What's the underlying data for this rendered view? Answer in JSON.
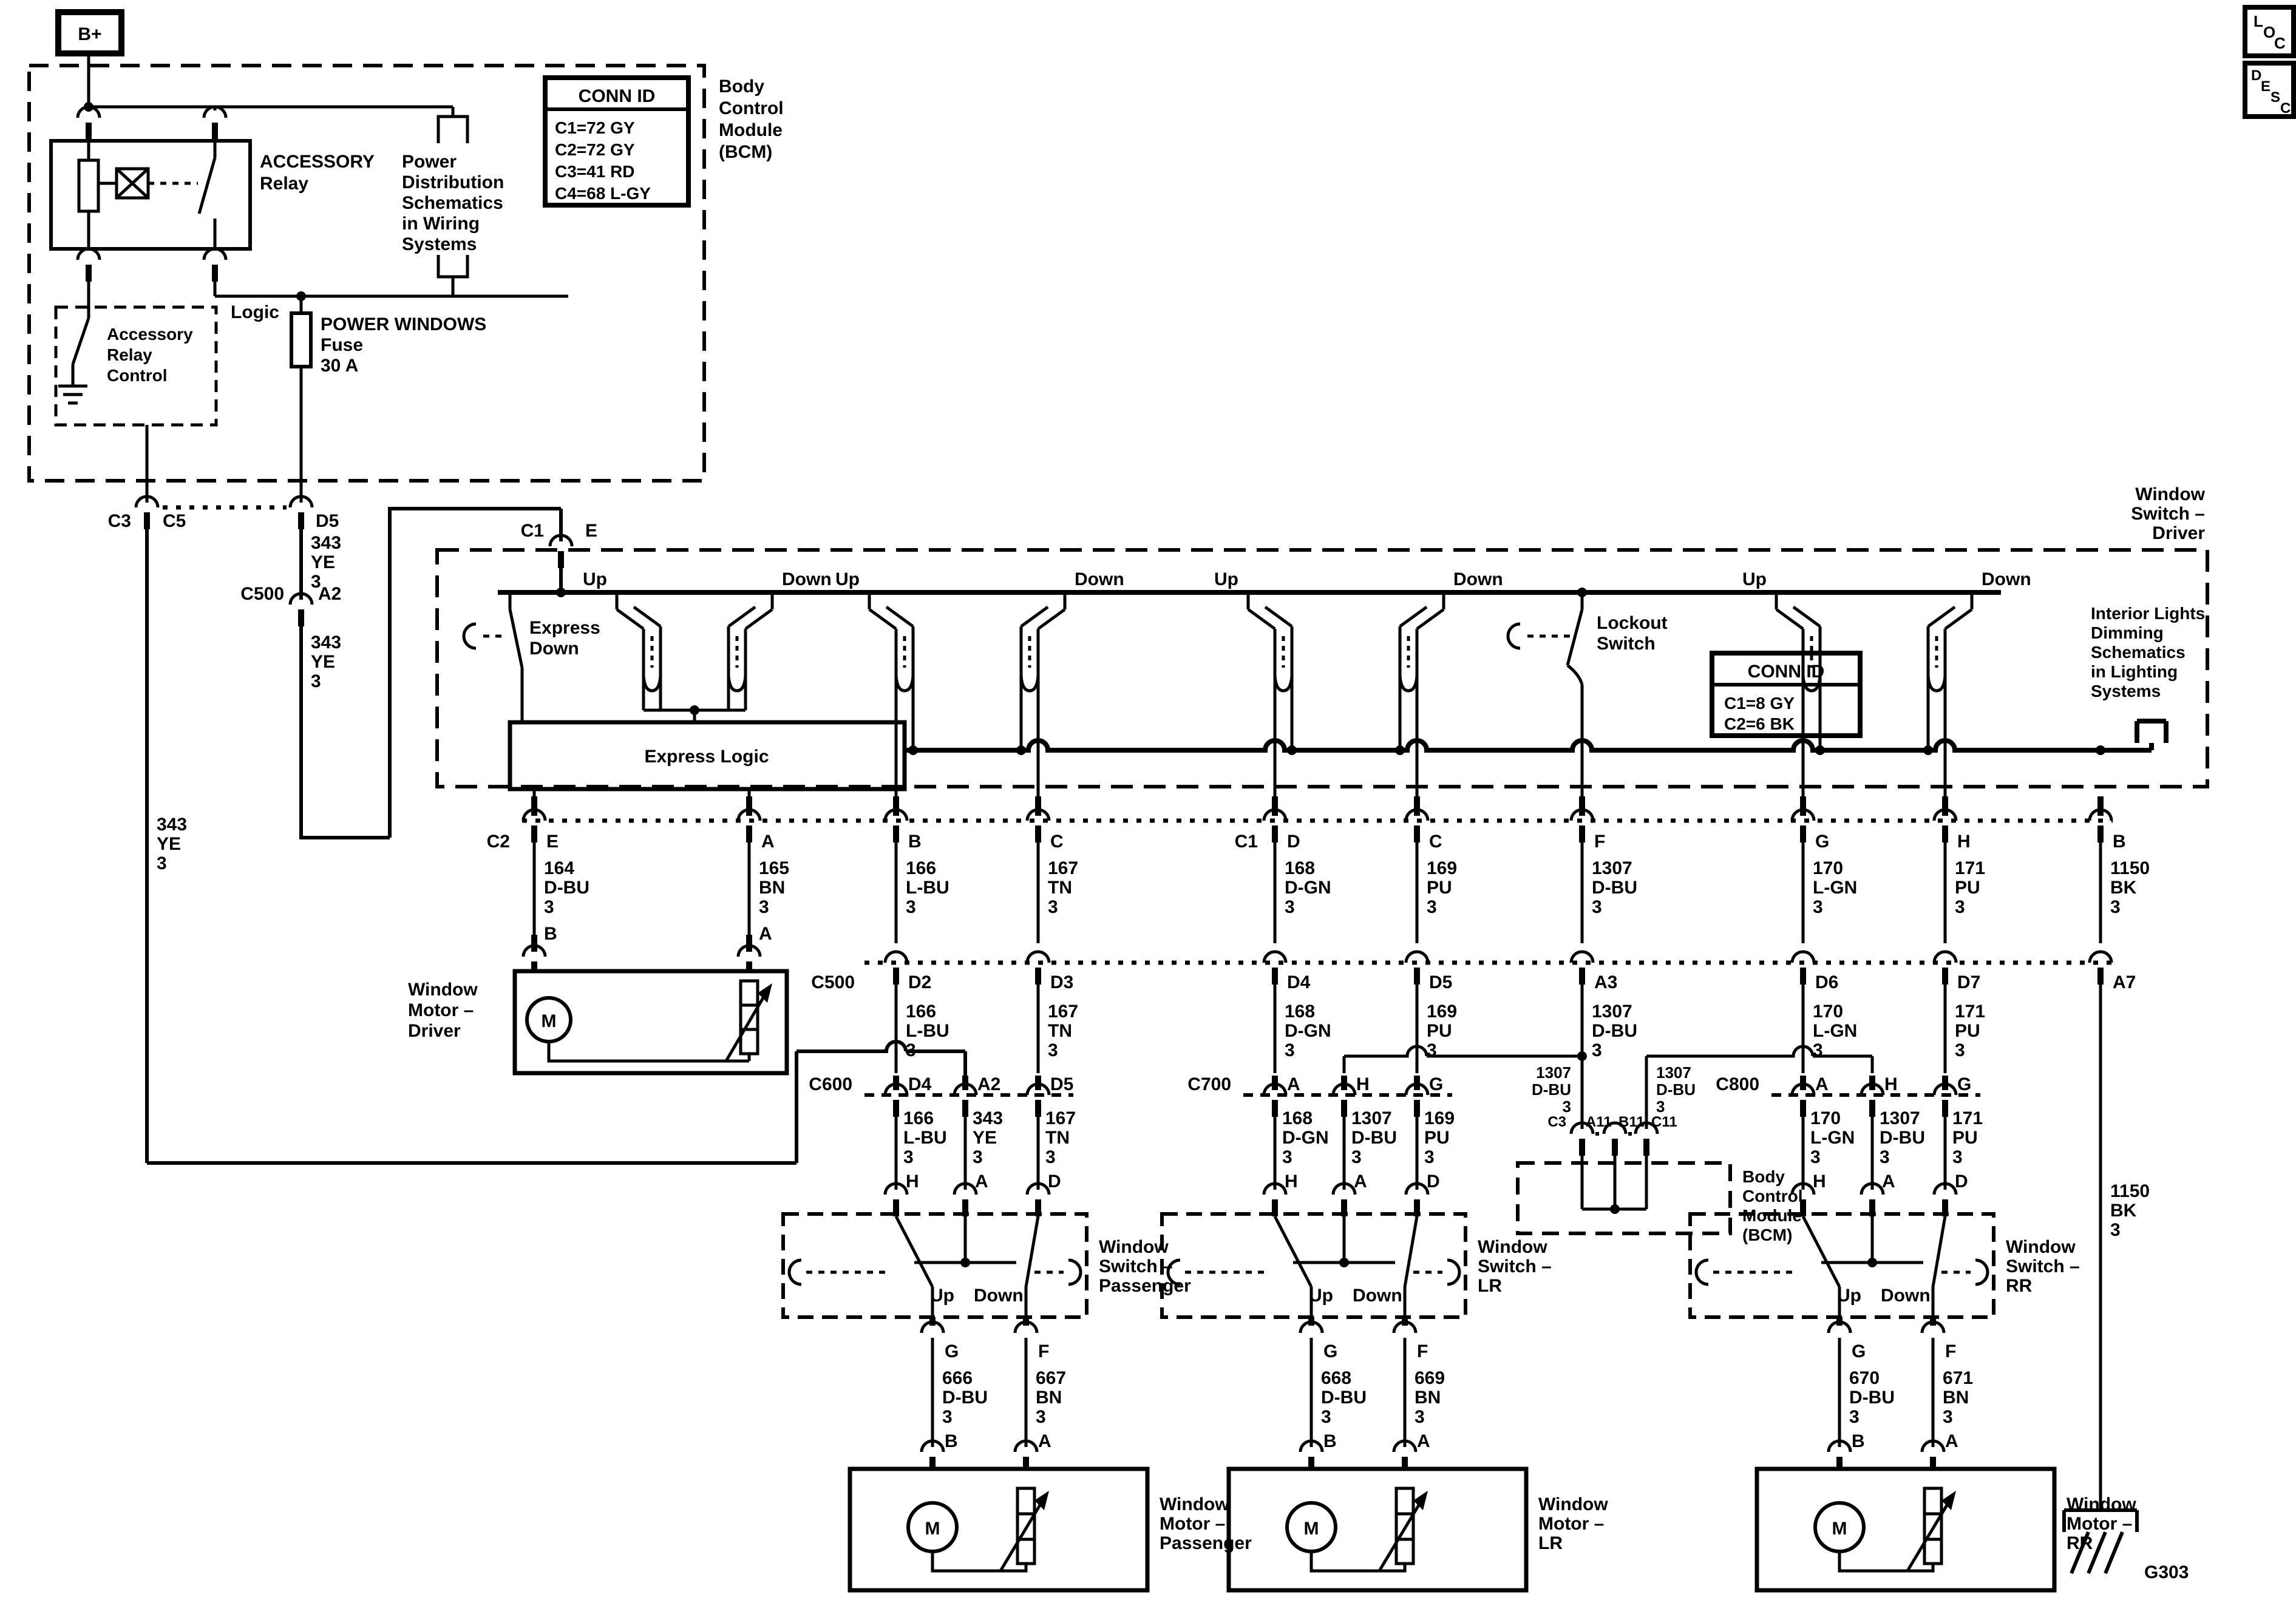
{
  "corner": {
    "loc": [
      "L",
      "O",
      "C"
    ],
    "desc": [
      "D",
      "E",
      "S",
      "C"
    ]
  },
  "top": {
    "b_plus": "B+",
    "accessory_relay": [
      "ACCESSORY",
      "Relay"
    ],
    "power_dist": [
      "Power",
      "Distribution",
      "Schematics",
      "in Wiring",
      "Systems"
    ],
    "conn_id": {
      "header": "CONN ID",
      "rows": [
        "C1=72 GY",
        "C2=72 GY",
        "C3=41 RD",
        "C4=68 L-GY"
      ]
    },
    "bcm": [
      "Body",
      "Control",
      "Module",
      "(BCM)"
    ],
    "arc_control": [
      "Accessory",
      "Relay",
      "Control"
    ],
    "logic": "Logic",
    "fuse": [
      "POWER WINDOWS",
      "Fuse",
      "30 A"
    ]
  },
  "feed": {
    "c3": "C3",
    "c5": "C5",
    "d5": "D5",
    "wire343_a": [
      "343",
      "YE",
      "3"
    ],
    "c500": "C500",
    "a2": "A2",
    "wire343_b": [
      "343",
      "YE",
      "3"
    ],
    "c1": "C1",
    "e": "E",
    "left343": [
      "343",
      "YE",
      "3"
    ]
  },
  "driver": {
    "title": [
      "Window",
      "Switch –",
      "Driver"
    ],
    "express_down": [
      "Express",
      "Down"
    ],
    "express_logic": "Express Logic",
    "lockout": [
      "Lockout",
      "Switch"
    ],
    "conn_id": {
      "header": "CONN ID",
      "rows": [
        "C1=8 GY",
        "C2=6 BK"
      ]
    },
    "interior": [
      "Interior Lights",
      "Dimming",
      "Schematics",
      "in Lighting",
      "Systems"
    ]
  },
  "ui": {
    "up": "Up",
    "down": "Down",
    "m": "M"
  },
  "row1": {
    "c2": "C2",
    "c1": "C1",
    "pins": [
      "E",
      "A",
      "B",
      "C",
      "D",
      "C",
      "F",
      "G",
      "H",
      "B"
    ],
    "wires": [
      [
        "164",
        "D-BU",
        "3"
      ],
      [
        "165",
        "BN",
        "3"
      ],
      [
        "166",
        "L-BU",
        "3"
      ],
      [
        "167",
        "TN",
        "3"
      ],
      [
        "168",
        "D-GN",
        "3"
      ],
      [
        "169",
        "PU",
        "3"
      ],
      [
        "1307",
        "D-BU",
        "3"
      ],
      [
        "170",
        "L-GN",
        "3"
      ],
      [
        "171",
        "PU",
        "3"
      ],
      [
        "1150",
        "BK",
        "3"
      ]
    ],
    "lower": [
      "B",
      "A"
    ]
  },
  "c500": {
    "label": "C500",
    "pins": [
      "D2",
      "D3",
      "D4",
      "D5",
      "A3",
      "D6",
      "D7",
      "A7"
    ],
    "wires": [
      [
        "166",
        "L-BU",
        "3"
      ],
      [
        "167",
        "TN",
        "3"
      ],
      [
        "168",
        "D-GN",
        "3"
      ],
      [
        "169",
        "PU",
        "3"
      ],
      [
        "1307",
        "D-BU",
        "3"
      ],
      [
        "170",
        "L-GN",
        "3"
      ],
      [
        "171",
        "PU",
        "3"
      ]
    ]
  },
  "risers": {
    "left": [
      "1307",
      "D-BU",
      "3"
    ],
    "right": [
      "1307",
      "D-BU",
      "3"
    ]
  },
  "bcm2": {
    "c3": "C3",
    "pins": [
      "A11",
      "B11",
      "C11"
    ],
    "label": [
      "Body",
      "Control",
      "Module",
      "(BCM)"
    ]
  },
  "doors": [
    {
      "box_dashed": true,
      "conn": "C600",
      "pins": [
        "D4",
        "A2",
        "D5"
      ],
      "wires": [
        [
          "166",
          "L-BU",
          "3"
        ],
        [
          "343",
          "YE",
          "3"
        ],
        [
          "167",
          "TN",
          "3"
        ]
      ],
      "sw": [
        "H",
        "A",
        "D"
      ],
      "box": [
        "Window",
        "Switch –",
        "Passenger"
      ],
      "out_pins": [
        "G",
        "F"
      ],
      "out_wires": [
        [
          "666",
          "D-BU",
          "3"
        ],
        [
          "667",
          "BN",
          "3"
        ]
      ],
      "out_lower": [
        "B",
        "A"
      ],
      "motor": [
        "Window",
        "Motor –",
        "Passenger"
      ]
    },
    {
      "box_dashed": false,
      "conn": "C700",
      "pins": [
        "A",
        "H",
        "G"
      ],
      "wires": [
        [
          "168",
          "D-GN",
          "3"
        ],
        [
          "1307",
          "D-BU",
          "3"
        ],
        [
          "169",
          "PU",
          "3"
        ]
      ],
      "sw": [
        "H",
        "A",
        "D"
      ],
      "box": [
        "Window",
        "Switch –",
        "LR"
      ],
      "out_pins": [
        "G",
        "F"
      ],
      "out_wires": [
        [
          "668",
          "D-BU",
          "3"
        ],
        [
          "669",
          "BN",
          "3"
        ]
      ],
      "out_lower": [
        "B",
        "A"
      ],
      "motor": [
        "Window",
        "Motor –",
        "LR"
      ]
    },
    {
      "box_dashed": false,
      "conn": "C800",
      "pins": [
        "A",
        "H",
        "G"
      ],
      "wires": [
        [
          "170",
          "L-GN",
          "3"
        ],
        [
          "1307",
          "D-BU",
          "3"
        ],
        [
          "171",
          "PU",
          "3"
        ]
      ],
      "sw": [
        "H",
        "A",
        "D"
      ],
      "box": [
        "Window",
        "Switch –",
        "RR"
      ],
      "out_pins": [
        "G",
        "F"
      ],
      "out_wires": [
        [
          "670",
          "D-BU",
          "3"
        ],
        [
          "671",
          "BN",
          "3"
        ]
      ],
      "out_lower": [
        "B",
        "A"
      ],
      "motor": [
        "Window",
        "Motor –",
        "RR"
      ]
    }
  ],
  "motor_driver": {
    "label": [
      "Window",
      "Motor –",
      "Driver"
    ]
  },
  "ground": {
    "g303": "G303",
    "wire": [
      "1150",
      "BK",
      "3"
    ]
  }
}
